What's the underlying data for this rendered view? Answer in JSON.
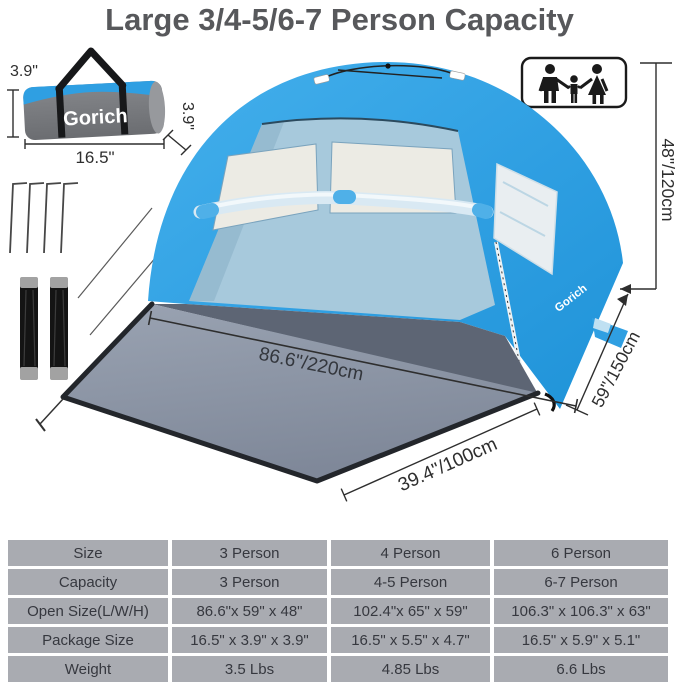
{
  "title": "Large 3/4-5/6-7 Person Capacity",
  "brand": "Gorich",
  "bag": {
    "logo": "Gorich",
    "height_label": "3.9\"",
    "depth_label": "3.9\"",
    "width_label": "16.5\""
  },
  "tent": {
    "side_logo": "Gorich",
    "height_label": "48\"/120cm",
    "depth_label": "59\"/150cm",
    "floor_width_label": "86.6\"/220cm",
    "mat_depth_label": "39.4\"/100cm"
  },
  "icons": {
    "capacity_icon": "family-man-child-woman"
  },
  "colors": {
    "tent_blue": "#2f9fe2",
    "interior_blue": "#a7c9dc",
    "mesh_white": "#ecebe4",
    "mat_gray": "#8a93a3",
    "floor_gray": "#5d6574",
    "table_cell": "#a9abb1",
    "title_gray": "#57585b"
  },
  "table": {
    "rows": [
      {
        "label": "Size",
        "cols": [
          "3 Person",
          "4 Person",
          "6 Person"
        ]
      },
      {
        "label": "Capacity",
        "cols": [
          "3 Person",
          "4-5 Person",
          "6-7 Person"
        ]
      },
      {
        "label": "Open Size(L/W/H)",
        "cols": [
          "86.6\"x 59\" x 48\"",
          "102.4\"x 65\" x 59\"",
          "106.3\" x 106.3\" x 63\""
        ]
      },
      {
        "label": "Package Size",
        "cols": [
          "16.5\" x 3.9\" x 3.9\"",
          "16.5\" x 5.5\" x 4.7\"",
          "16.5\" x 5.9\" x 5.1\""
        ]
      },
      {
        "label": "Weight",
        "cols": [
          "3.5 Lbs",
          "4.85 Lbs",
          "6.6 Lbs"
        ]
      }
    ]
  }
}
